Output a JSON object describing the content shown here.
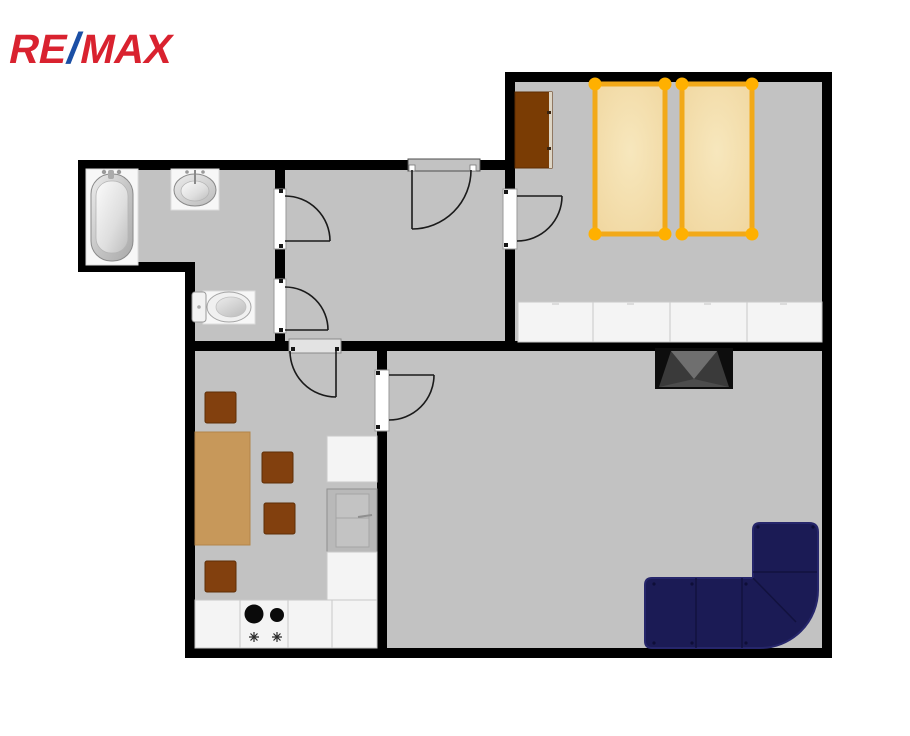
{
  "logo": {
    "re": "RE",
    "slash": "/",
    "max": "MAX"
  },
  "colors": {
    "wall": "#000000",
    "floor": "#c2c2c2",
    "page_bg": "#ffffff",
    "logo_red": "#d9222f",
    "logo_blue": "#1b4fa5",
    "wardrobe": "#7a3c04",
    "chair": "#82400e",
    "table": "#c7985a",
    "bed_frame": "#f2a918",
    "bed_knob": "#ffb000",
    "mattress": "#f2daa4",
    "cabinet": "#f4f4f4",
    "cabinet_border": "#c9c9c9",
    "appliance": "#b9b9b9",
    "appliance_border": "#8f8f8f",
    "sofa": "#1b1b55",
    "sofa_seam": "#12123e",
    "sofa_edge": "#26266b",
    "tv_body": "#0d0d0d",
    "tv_back": "#3a3a3a",
    "tv_facet": "#6f6f6f",
    "door_line": "#1a1a1a"
  }
}
